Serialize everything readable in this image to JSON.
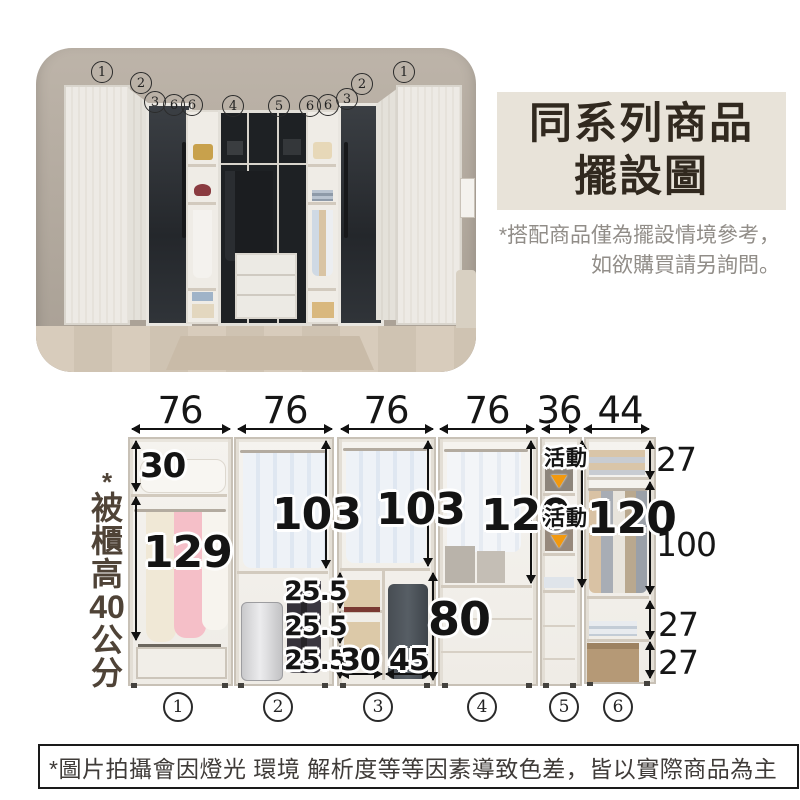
{
  "photo": {
    "callouts": [
      "1",
      "2",
      "3",
      "6",
      "6",
      "4",
      "5",
      "6",
      "6",
      "3",
      "2",
      "1"
    ]
  },
  "title": {
    "line1": "同系列商品",
    "line2": "擺設圖"
  },
  "title_note": {
    "line1": "*搭配商品僅為擺設情境參考，",
    "line2": "如欲購買請另詢問。"
  },
  "side_note": {
    "chars": [
      "*",
      "被",
      "櫃",
      "高",
      "40",
      "公",
      "分"
    ]
  },
  "diagram": {
    "top_widths": [
      "76",
      "76",
      "76",
      "76",
      "36",
      "44"
    ],
    "right_heights": [
      "27",
      "100",
      "27",
      "27"
    ],
    "labels": {
      "u1_top": "30",
      "u1_hang": "129",
      "u2_hang": "103",
      "u3_hang": "103",
      "gap1": "25.5",
      "gap2": "25.5",
      "gap3": "25.5",
      "u3_w_left": "30",
      "u3_w_right": "45",
      "u3_low_h": "80",
      "u4_hang": "120",
      "u5_col": "120",
      "movable": "活動"
    },
    "unit_numbers": [
      "1",
      "2",
      "3",
      "4",
      "5",
      "6"
    ]
  },
  "disclaimer": "*圖片拍攝會因燈光 環境 解析度等等因素導致色差，皆以實際商品為主"
}
